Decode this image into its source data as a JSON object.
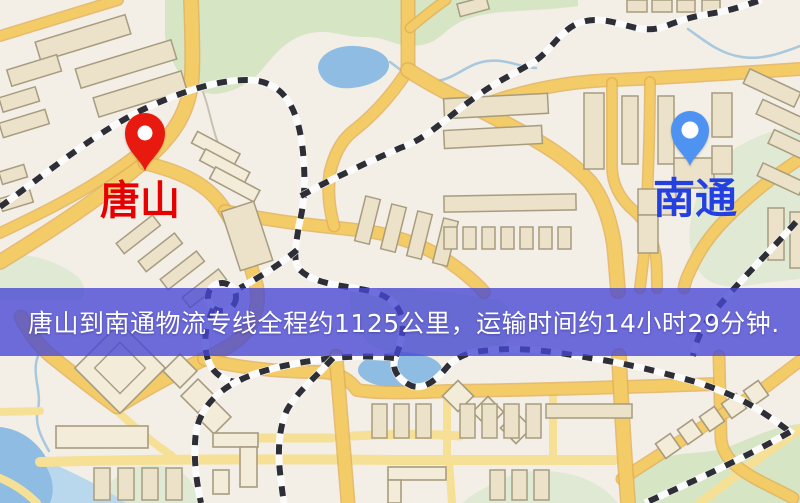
{
  "banner": {
    "text": "唐山到南通物流专线全程约1125公里，运输时间约14小时29分钟.",
    "bg": "rgba(70,70,213,0.78)",
    "text_color": "#ffffff"
  },
  "markers": {
    "origin": {
      "label": "唐山",
      "pin_color": "#e8190e",
      "label_color": "#e60000"
    },
    "destination": {
      "label": "南通",
      "pin_color": "#4e92f2",
      "label_color": "#2440e0"
    }
  },
  "map_theme": {
    "background": "#f3eee6",
    "road": "#f3cc67",
    "road_casing": "#e2ae55",
    "road_minor": "#f6e096",
    "building_fill": "#ebe2c9",
    "building_stroke": "#a89c80",
    "park": "#d6e5c4",
    "park_pale": "#dfe9d3",
    "water": "#8fbce2",
    "water_light": "#b9d8ee",
    "railway_dash": "#2e2e36",
    "railway_base": "#fbfbfb",
    "stream": "#a8c8de"
  }
}
